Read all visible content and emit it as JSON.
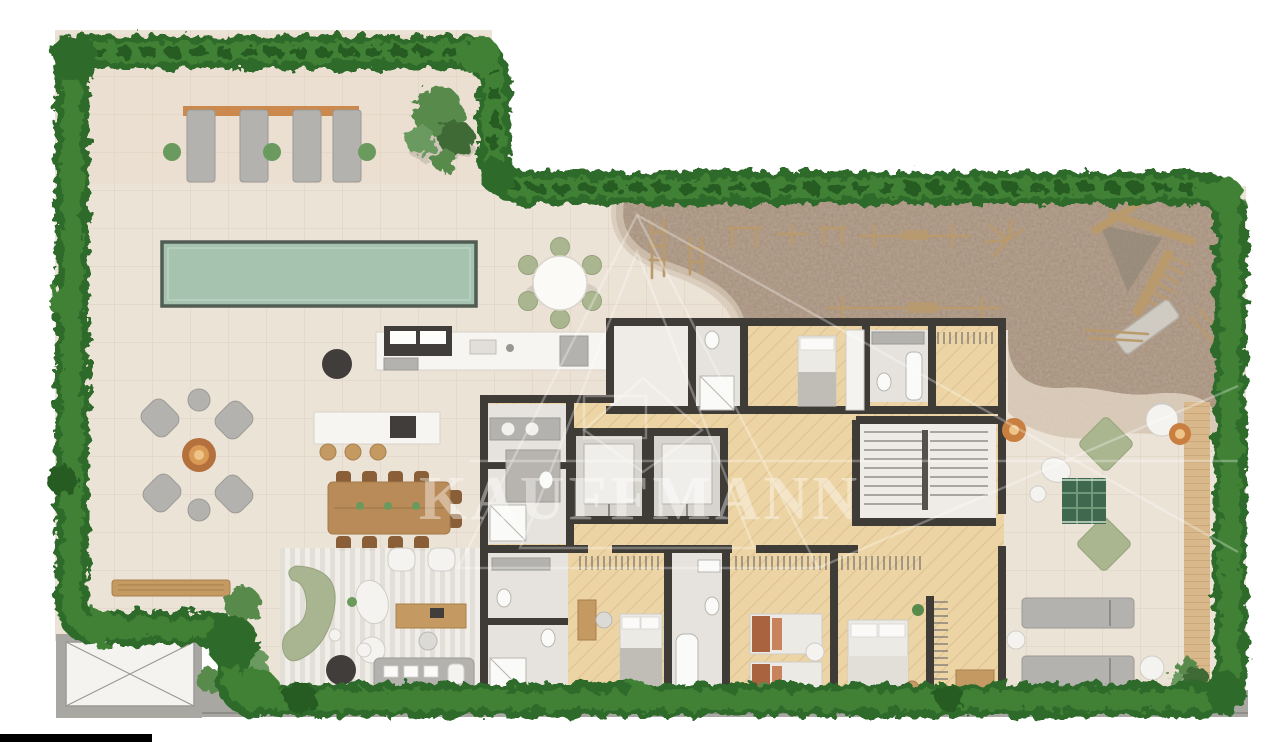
{
  "page": {
    "width": 1280,
    "height": 742,
    "background": "#ffffff"
  },
  "watermark": {
    "text": "KAUFFMANN",
    "color": "#ffffff",
    "opacity": 0.55
  },
  "palette": {
    "page_bg": "#ffffff",
    "deck": "#ece3d7",
    "deck_line": "#dccfc0",
    "deck_tint": "#e7d6c5",
    "hedge_dark": "#2f6a2c",
    "hedge_mid": "#3f8136",
    "hedge_deep": "#265b23",
    "hedge_light": "#4f9441",
    "pool": "#a6c3af",
    "pool_border": "#515c54",
    "mulch": "#a18a76",
    "sand": "#d6c7b5",
    "wall": "#3f3b37",
    "wood_floor": "#ecd4a4",
    "wood_line": "#ddc192",
    "tile": "#e6e3de",
    "white_room": "#efece7",
    "counter": "#f7f5f1",
    "appliance_dark": "#413d3a",
    "gray_item": "#b3b2ae",
    "white_furn": "#f4f3f0",
    "sofa_green": "#a9b490",
    "chair_green": "#a9b68f",
    "rug_green": "#3f684e",
    "wood_furn": "#c49a62",
    "wood_dark": "#8a5f38",
    "table_wood": "#b98b58",
    "accent_orange": "#c87f3f",
    "accent_glow": "#eec489",
    "rust_pillow": "#a9633f",
    "play_wood": "#b99a6d",
    "plant_dark": "#3f6b35",
    "plant_mid": "#588a4b",
    "plant_light": "#6a9a5e",
    "concrete": "#a8a7a2",
    "walk_dark": "#8f8e89",
    "deck_wood": "#d9b98c",
    "deck_wood_line": "#c5a274",
    "black_bar": "#000000"
  }
}
